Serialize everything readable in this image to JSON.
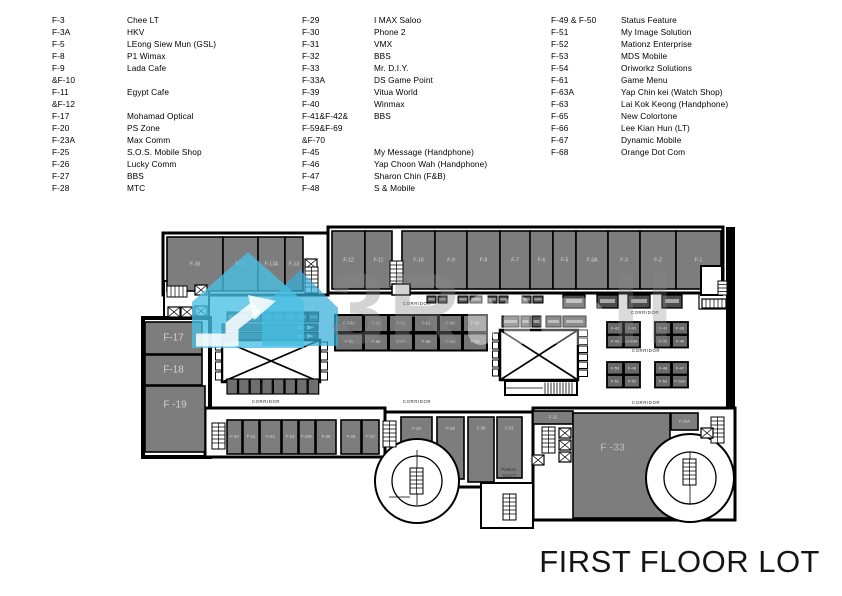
{
  "title": "FIRST FLOOR LOT",
  "legend": {
    "columns": [
      {
        "entries": [
          {
            "lot": "F-3",
            "name": "Chee LT"
          },
          {
            "lot": "F-3A",
            "name": "HKV"
          },
          {
            "lot": "F-5",
            "name": "LEong Siew Mun (GSL)"
          },
          {
            "lot": "F-8",
            "name": "P1 Wimax"
          },
          {
            "lot": "F-9",
            "name": "Lada Cafe"
          },
          {
            "lot": "&F-10",
            "name": ""
          },
          {
            "lot": "F-11",
            "name": "Egypt Cafe"
          },
          {
            "lot": "&F-12",
            "name": ""
          },
          {
            "lot": "F-17",
            "name": "Mohamad Optical"
          },
          {
            "lot": "F-20",
            "name": "PS Zone"
          },
          {
            "lot": "F-23A",
            "name": "Max Comm"
          },
          {
            "lot": "F-25",
            "name": "S.O.S. Mobile Shop"
          },
          {
            "lot": "F-26",
            "name": "Lucky Comm"
          },
          {
            "lot": "F-27",
            "name": "BBS"
          },
          {
            "lot": "F-28",
            "name": "MTC"
          }
        ]
      },
      {
        "entries": [
          {
            "lot": "F-29",
            "name": "I MAX Saloo"
          },
          {
            "lot": "F-30",
            "name": "Phone 2"
          },
          {
            "lot": "F-31",
            "name": "VMX"
          },
          {
            "lot": "F-32",
            "name": "BBS"
          },
          {
            "lot": "F-33",
            "name": "Mr. D.I.Y."
          },
          {
            "lot": "F-33A",
            "name": "DS Game Point"
          },
          {
            "lot": "F-39",
            "name": "Vitua World"
          },
          {
            "lot": "F-40",
            "name": "Winmax"
          },
          {
            "lot": "F-41&F-42&",
            "name": "BBS"
          },
          {
            "lot": "F-59&F-69",
            "name": ""
          },
          {
            "lot": "&F-70",
            "name": ""
          },
          {
            "lot": "F-45",
            "name": "My Message (Handphone)"
          },
          {
            "lot": "F-46",
            "name": "Yap Choon Wah (Handphone)"
          },
          {
            "lot": "F-47",
            "name": "Sharon Chin (F&B)"
          },
          {
            "lot": "F-48",
            "name": "S & Mobile"
          }
        ]
      },
      {
        "entries": [
          {
            "lot": "F-49 & F-50",
            "name": "Status Feature"
          },
          {
            "lot": "F-51",
            "name": "My Image Solution"
          },
          {
            "lot": "F-52",
            "name": "Mationz Enterprise"
          },
          {
            "lot": "F-53",
            "name": "MDS Mobile"
          },
          {
            "lot": "F-54",
            "name": "Oriworkz Solutions"
          },
          {
            "lot": "F-61",
            "name": "Game Menu"
          },
          {
            "lot": "F-63A",
            "name": "Yap Chin kei (Watch Shop)"
          },
          {
            "lot": "F-63",
            "name": "Lai Kok Keong (Handphone)"
          },
          {
            "lot": "F-65",
            "name": "New Colortone"
          },
          {
            "lot": "F-66",
            "name": "Lee Kian Hun (LT)"
          },
          {
            "lot": "F-67",
            "name": "Dynamic Mobile"
          },
          {
            "lot": "F-68",
            "name": "Orange Dot Com"
          }
        ]
      }
    ]
  },
  "plan": {
    "corridor_label": "CORRIDOR",
    "corridor_positions": [
      [
        266,
        305
      ],
      [
        417,
        305
      ],
      [
        645,
        314
      ],
      [
        646,
        352
      ],
      [
        266,
        403
      ],
      [
        417,
        403
      ],
      [
        646,
        404
      ]
    ],
    "public_toilet_lines": [
      "PUBLIC",
      "TOILET"
    ],
    "units": [
      {
        "l": "F-16",
        "x": 167,
        "y": 237,
        "w": 56,
        "h": 54
      },
      {
        "l": "F-15",
        "x": 223,
        "y": 237,
        "w": 35,
        "h": 54
      },
      {
        "l": "F-13A",
        "x": 258,
        "y": 237,
        "w": 27,
        "h": 54
      },
      {
        "l": "F-13",
        "x": 285,
        "y": 237,
        "w": 18,
        "h": 54
      },
      {
        "l": "F-12",
        "x": 332,
        "y": 231,
        "w": 33,
        "h": 58
      },
      {
        "l": "F-11",
        "x": 365,
        "y": 231,
        "w": 27,
        "h": 58
      },
      {
        "l": "F-10",
        "x": 402,
        "y": 231,
        "w": 33,
        "h": 58
      },
      {
        "l": "F-9",
        "x": 435,
        "y": 231,
        "w": 32,
        "h": 58
      },
      {
        "l": "F-8",
        "x": 467,
        "y": 231,
        "w": 33,
        "h": 58
      },
      {
        "l": "F-7",
        "x": 500,
        "y": 231,
        "w": 30,
        "h": 58
      },
      {
        "l": "F-6",
        "x": 530,
        "y": 231,
        "w": 23,
        "h": 58
      },
      {
        "l": "F-5",
        "x": 553,
        "y": 231,
        "w": 23,
        "h": 58
      },
      {
        "l": "F-3A",
        "x": 576,
        "y": 231,
        "w": 32,
        "h": 58
      },
      {
        "l": "F-3",
        "x": 608,
        "y": 231,
        "w": 32,
        "h": 58
      },
      {
        "l": "F-2",
        "x": 640,
        "y": 231,
        "w": 36,
        "h": 58
      },
      {
        "l": "F-1",
        "x": 676,
        "y": 231,
        "w": 45,
        "h": 58
      },
      {
        "l": "F-17",
        "x": 145,
        "y": 322,
        "w": 57,
        "h": 32,
        "fs": 10,
        "tc": "#cfcfcf"
      },
      {
        "l": "F-18",
        "x": 145,
        "y": 355,
        "w": 57,
        "h": 30,
        "fs": 10,
        "tc": "#cfcfcf"
      },
      {
        "l": "F -19",
        "x": 145,
        "y": 386,
        "w": 60,
        "h": 66,
        "fs": 10,
        "tc": "#cfcfcf",
        "ty": -14
      },
      {
        "l": "F-63A",
        "x": 335,
        "y": 315,
        "w": 28,
        "h": 17,
        "f": "#767676",
        "sw": 2,
        "fs": 4.3,
        "tc": "#cfcfcf"
      },
      {
        "l": "F-63",
        "x": 364,
        "y": 315,
        "w": 24,
        "h": 17,
        "f": "#767676",
        "sw": 2,
        "fs": 4.3,
        "tc": "#cfcfcf"
      },
      {
        "l": "F-62",
        "x": 389,
        "y": 315,
        "w": 24,
        "h": 17,
        "f": "#767676",
        "sw": 2,
        "fs": 4.3,
        "tc": "#cfcfcf"
      },
      {
        "l": "F-61",
        "x": 414,
        "y": 315,
        "w": 24,
        "h": 17,
        "f": "#767676",
        "sw": 2,
        "fs": 4.3,
        "tc": "#cfcfcf"
      },
      {
        "l": "F-60",
        "x": 439,
        "y": 315,
        "w": 23,
        "h": 17,
        "f": "#767676",
        "sw": 2,
        "fs": 4.3,
        "tc": "#cfcfcf"
      },
      {
        "l": "F-59",
        "x": 463,
        "y": 315,
        "w": 24,
        "h": 17,
        "f": "#767676",
        "sw": 2,
        "fs": 4.3,
        "tc": "#cfcfcf"
      },
      {
        "l": "F-65",
        "x": 335,
        "y": 333.5,
        "w": 28,
        "h": 17,
        "f": "#767676",
        "sw": 2,
        "fs": 4.3,
        "tc": "#cfcfcf"
      },
      {
        "l": "F-66",
        "x": 364,
        "y": 333.5,
        "w": 24,
        "h": 17,
        "f": "#767676",
        "sw": 2,
        "fs": 4.3,
        "tc": "#cfcfcf"
      },
      {
        "l": "F-67",
        "x": 389,
        "y": 333.5,
        "w": 24,
        "h": 17,
        "f": "#767676",
        "sw": 2,
        "fs": 4.3,
        "tc": "#cfcfcf"
      },
      {
        "l": "F-68",
        "x": 414,
        "y": 333.5,
        "w": 24,
        "h": 17,
        "f": "#767676",
        "sw": 2,
        "fs": 4.3,
        "tc": "#cfcfcf"
      },
      {
        "l": "F-69",
        "x": 439,
        "y": 333.5,
        "w": 23,
        "h": 17,
        "f": "#767676",
        "sw": 2,
        "fs": 4.3,
        "tc": "#cfcfcf"
      },
      {
        "l": "F-70",
        "x": 463,
        "y": 333.5,
        "w": 24,
        "h": 17,
        "f": "#767676",
        "sw": 2,
        "fs": 4.3,
        "tc": "#cfcfcf"
      },
      {
        "l": "F-42",
        "x": 607,
        "y": 322,
        "w": 16,
        "h": 12.5,
        "f": "#696969",
        "sw": 1.8,
        "fs": 4,
        "tc": "#e3e3e3"
      },
      {
        "l": "F-41",
        "x": 624,
        "y": 322,
        "w": 16,
        "h": 12.5,
        "f": "#696969",
        "sw": 1.8,
        "fs": 4,
        "tc": "#e3e3e3"
      },
      {
        "l": "F-43",
        "x": 607,
        "y": 335,
        "w": 16,
        "h": 12.5,
        "f": "#696969",
        "sw": 1.8,
        "fs": 4,
        "tc": "#e3e3e3"
      },
      {
        "l": "F-43A",
        "x": 624,
        "y": 335,
        "w": 16,
        "h": 12.5,
        "f": "#696969",
        "sw": 1.8,
        "fs": 4,
        "tc": "#e3e3e3"
      },
      {
        "l": "F-40",
        "x": 655,
        "y": 322,
        "w": 16,
        "h": 12.5,
        "f": "#696969",
        "sw": 1.8,
        "fs": 4,
        "tc": "#e3e3e3"
      },
      {
        "l": "F-39",
        "x": 672,
        "y": 322,
        "w": 16,
        "h": 12.5,
        "f": "#696969",
        "sw": 1.8,
        "fs": 4,
        "tc": "#e3e3e3"
      },
      {
        "l": "F-45",
        "x": 655,
        "y": 335,
        "w": 16,
        "h": 12.5,
        "f": "#696969",
        "sw": 1.8,
        "fs": 4,
        "tc": "#e3e3e3"
      },
      {
        "l": "F-46",
        "x": 672,
        "y": 335,
        "w": 16,
        "h": 12.5,
        "f": "#696969",
        "sw": 1.8,
        "fs": 4,
        "tc": "#e3e3e3"
      },
      {
        "l": "F-50",
        "x": 607,
        "y": 362,
        "w": 16,
        "h": 12.5,
        "f": "#696969",
        "sw": 1.8,
        "fs": 4,
        "tc": "#e3e3e3"
      },
      {
        "l": "F-49",
        "x": 624,
        "y": 362,
        "w": 16,
        "h": 12.5,
        "f": "#696969",
        "sw": 1.8,
        "fs": 4,
        "tc": "#e3e3e3"
      },
      {
        "l": "F-51",
        "x": 607,
        "y": 375,
        "w": 16,
        "h": 12.5,
        "f": "#696969",
        "sw": 1.8,
        "fs": 4,
        "tc": "#e3e3e3"
      },
      {
        "l": "F-52",
        "x": 624,
        "y": 375,
        "w": 16,
        "h": 12.5,
        "f": "#696969",
        "sw": 1.8,
        "fs": 4,
        "tc": "#e3e3e3"
      },
      {
        "l": "F-48",
        "x": 655,
        "y": 362,
        "w": 16,
        "h": 12.5,
        "f": "#696969",
        "sw": 1.8,
        "fs": 4,
        "tc": "#e3e3e3"
      },
      {
        "l": "F-47",
        "x": 672,
        "y": 362,
        "w": 16,
        "h": 12.5,
        "f": "#696969",
        "sw": 1.8,
        "fs": 4,
        "tc": "#e3e3e3"
      },
      {
        "l": "F-53",
        "x": 655,
        "y": 375,
        "w": 16,
        "h": 12.5,
        "f": "#696969",
        "sw": 1.8,
        "fs": 4,
        "tc": "#e3e3e3"
      },
      {
        "l": "F-53A",
        "x": 672,
        "y": 375,
        "w": 16,
        "h": 12.5,
        "f": "#696969",
        "sw": 1.8,
        "fs": 4,
        "tc": "#e3e3e3"
      },
      {
        "l": "F-20",
        "x": 227,
        "y": 420,
        "w": 15,
        "h": 34,
        "fs": 4.2
      },
      {
        "l": "F-21",
        "x": 243,
        "y": 420,
        "w": 16,
        "h": 34,
        "fs": 4.2
      },
      {
        "l": "F-22",
        "x": 260,
        "y": 420,
        "w": 21,
        "h": 34,
        "fs": 4.2
      },
      {
        "l": "F-23",
        "x": 282,
        "y": 420,
        "w": 16,
        "h": 34,
        "fs": 4.2
      },
      {
        "l": "F-23A",
        "x": 299,
        "y": 420,
        "w": 16,
        "h": 34,
        "fs": 4.2
      },
      {
        "l": "F-25",
        "x": 316,
        "y": 420,
        "w": 20,
        "h": 34,
        "fs": 4.2
      },
      {
        "l": "F-26",
        "x": 341,
        "y": 420,
        "w": 20,
        "h": 34,
        "fs": 4.2
      },
      {
        "l": "F-27",
        "x": 362,
        "y": 420,
        "w": 17,
        "h": 34,
        "fs": 4.2
      },
      {
        "l": "F-28",
        "x": 401,
        "y": 417,
        "w": 31,
        "h": 38,
        "fs": 4.2,
        "ty": -7
      },
      {
        "l": "F-29",
        "x": 437,
        "y": 417,
        "w": 27,
        "h": 62,
        "fs": 4.2,
        "ty": -19
      },
      {
        "l": "F-30",
        "x": 468,
        "y": 417,
        "w": 26,
        "h": 65,
        "fs": 4.2,
        "ty": -21
      },
      {
        "l": "F-31",
        "x": 497,
        "y": 417,
        "w": 25,
        "h": 61,
        "fs": 4.2,
        "ty": -19
      },
      {
        "l": "F-32",
        "x": 533,
        "y": 411,
        "w": 40,
        "h": 13,
        "fs": 4.2
      },
      {
        "l": "F -33",
        "x": 573,
        "y": 413,
        "w": 97,
        "h": 105,
        "fs": 10.5,
        "tc": "#bdbdbd",
        "tx": -9,
        "ty": -18
      },
      {
        "l": "F-33A",
        "x": 671,
        "y": 413,
        "w": 27,
        "h": 17,
        "fs": 4
      }
    ]
  },
  "watermark": {
    "text_left": "3R",
    "text_right": "Il"
  },
  "colors": {
    "unit_fill": "#7d7d7d",
    "kiosk_fill": "#4c4c4c",
    "wall": "#000000",
    "watermark_cyan": "#49c0e4",
    "unit_label": "#d9d9d9"
  }
}
